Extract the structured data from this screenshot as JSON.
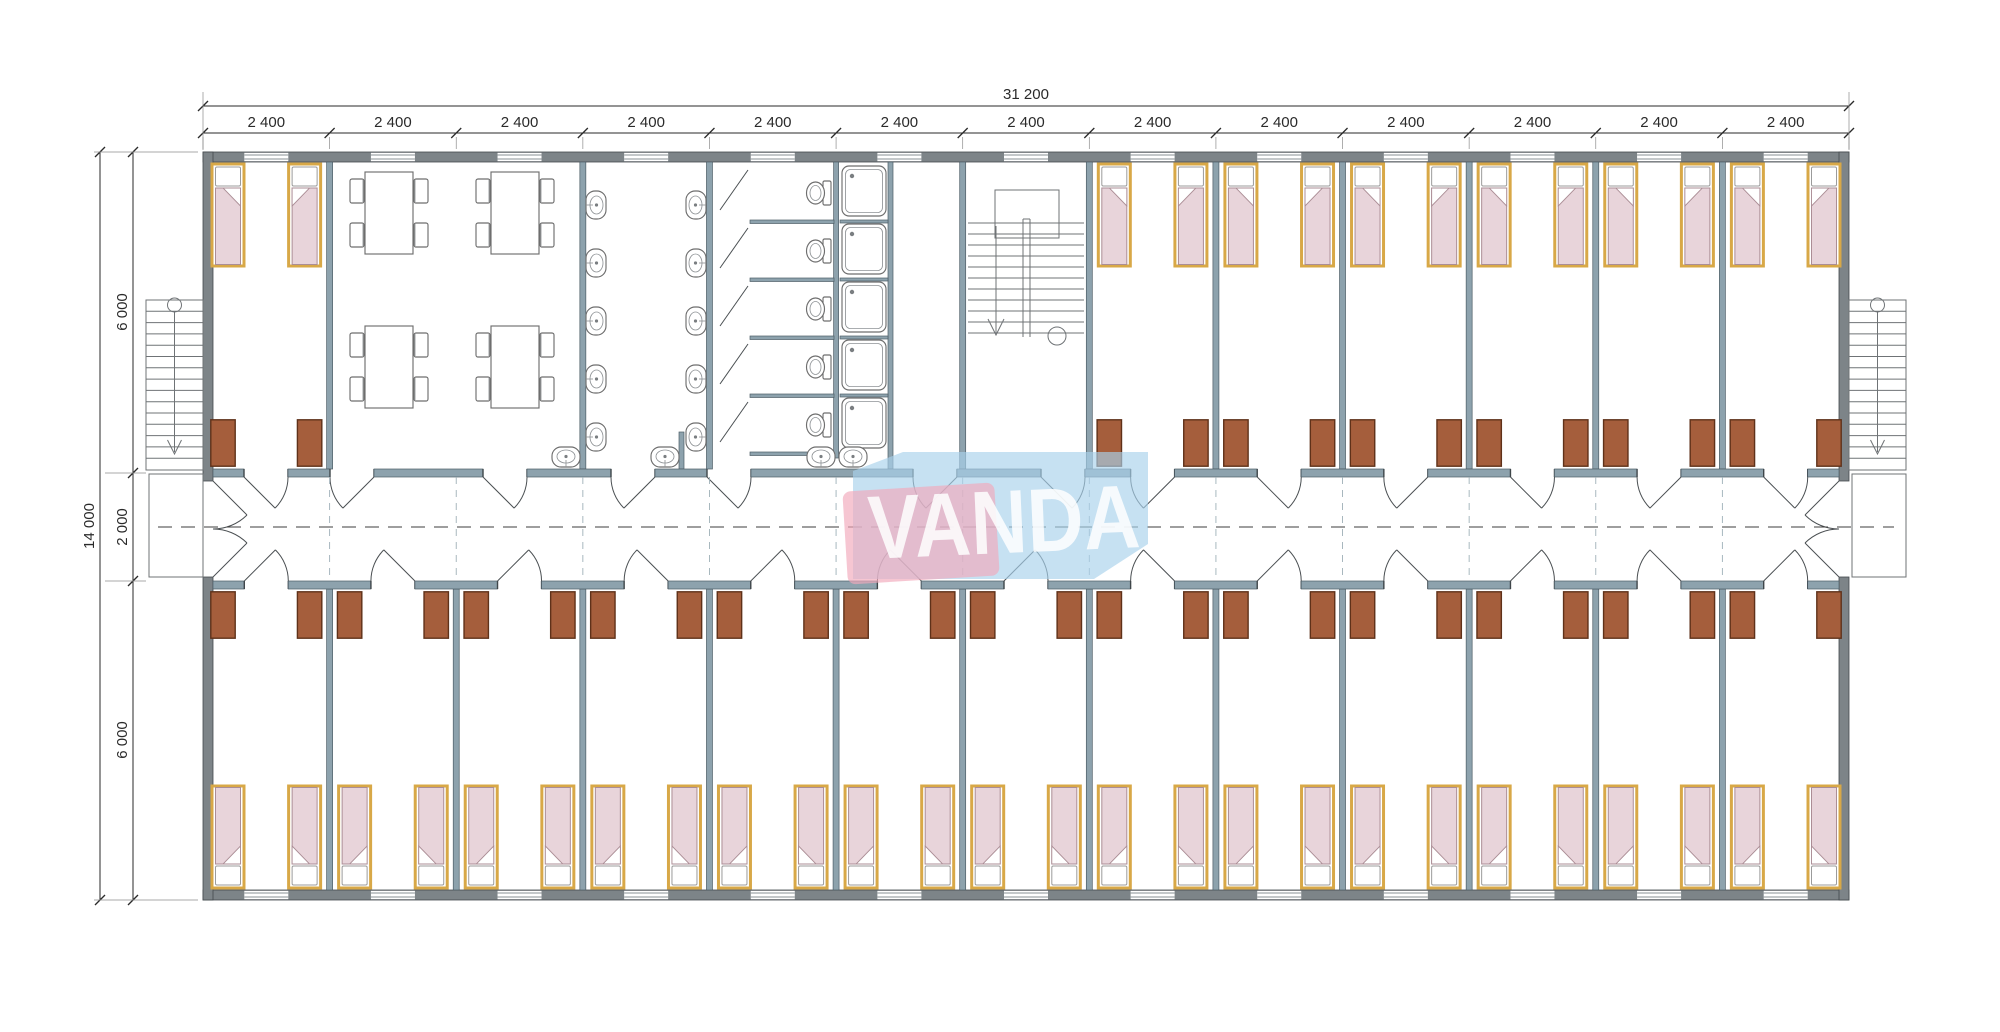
{
  "logo": {
    "text": "VANDA"
  },
  "colors": {
    "wall": "#7d8488",
    "partition": "#8da2ad",
    "bed_frame": "#d8a847",
    "mattress": "#e8d4da",
    "cabinet": "#a55e3c",
    "cabinet_border": "#5f3119",
    "fixture": "#6e6e6e",
    "dim": "#2a2a2a",
    "logo_pink": "#f2a9bb",
    "logo_blue": "#a9d1ec",
    "logo_text": "#ffffff"
  },
  "dimensions": {
    "total_width": "31 200",
    "column_labels": [
      "2 400",
      "2 400",
      "2 400",
      "2 400",
      "2 400",
      "2 400",
      "2 400",
      "2 400",
      "2 400",
      "2 400",
      "2 400",
      "2 400",
      "2 400"
    ],
    "left_labels": [
      "6 000",
      "2 000",
      "6 000"
    ],
    "total_height": "14 000"
  },
  "plan": {
    "type": "floor_plan",
    "grid": {
      "columns": 13,
      "column_width_mm": 2400,
      "total_width_mm": 31200,
      "top_rooms_depth_mm": 6000,
      "corridor_width_mm": 2000,
      "bottom_rooms_depth_mm": 6000,
      "total_depth_mm": 14000
    },
    "top_rooms": [
      {
        "type": "bedroom",
        "beds": 2,
        "wardrobes": 2
      },
      {
        "type": "dining-room",
        "spans_columns": 2,
        "tables": 4,
        "chairs": 16
      },
      {
        "type": "washroom",
        "wall_sinks": 10,
        "counter_sinks": 2
      },
      {
        "type": "toilet-shower-room",
        "toilet_stalls": 5,
        "showers": 5,
        "counter_sinks": 2
      },
      {
        "type": "vestibule"
      },
      {
        "type": "staircase"
      },
      {
        "type": "bedrooms",
        "rooms": 6,
        "beds_each": 2,
        "wardrobes_each": 2
      }
    ],
    "bottom_rooms": {
      "type": "bedrooms",
      "rooms": 13,
      "beds_each": 2,
      "wardrobes_each": 2
    },
    "exterior_stairs": 2,
    "totals": {
      "beds": 40,
      "wardrobes": 40,
      "tables": 4,
      "chairs": 16,
      "sinks": 14,
      "toilets": 5,
      "showers": 5
    }
  }
}
